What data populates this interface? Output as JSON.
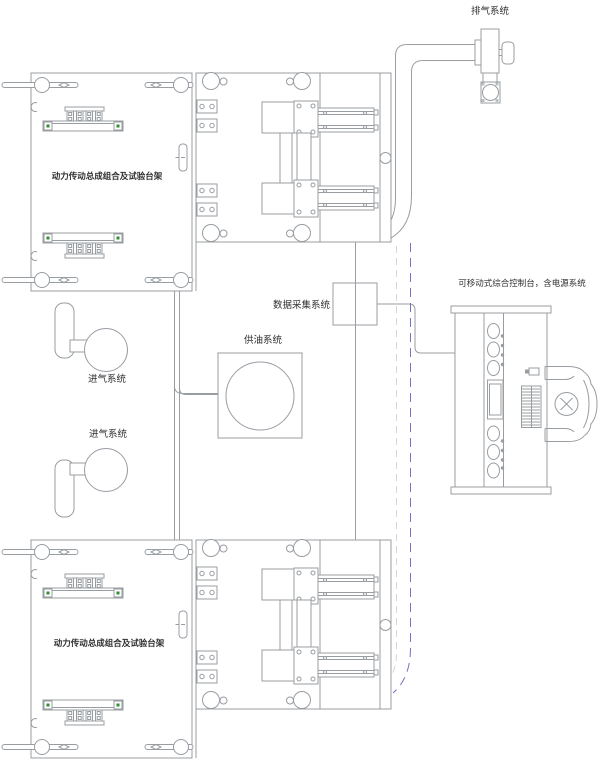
{
  "diagram": {
    "type": "engineering-layout-diagram",
    "labels": {
      "exhaust_system": "排气系统",
      "test_bench_top": "动力传动总成组合及试验台架",
      "test_bench_bottom": "动力传动总成组合及试验台架",
      "data_acquisition": "数据采集系统",
      "oil_supply": "供油系统",
      "intake_system_top": "进气系统",
      "intake_system_bottom": "进气系统",
      "control_console": "可移动式综合控制台，含电源系统"
    },
    "colors": {
      "outline": "#989da2",
      "text": "#2f2f2f",
      "phantom_blue": "#7473c6",
      "phantom_gray": "#d6d6d6",
      "marker_green": "#2f8f2f",
      "background": "#ffffff"
    }
  }
}
